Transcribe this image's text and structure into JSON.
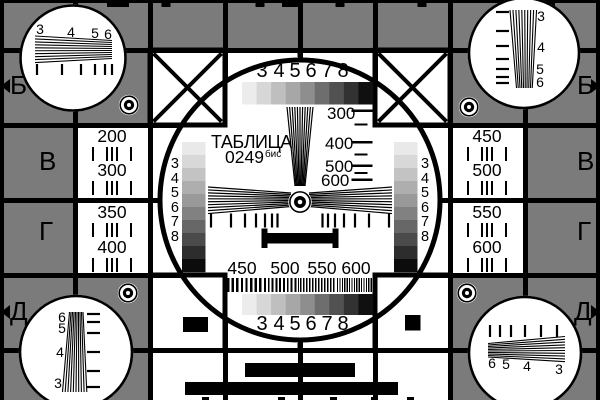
{
  "card": {
    "title": "ТАБЛИЦА",
    "code": "0249",
    "code_suffix": "бис",
    "row_markers": {
      "left": [
        "Б",
        "В",
        "Г",
        "Д"
      ],
      "right": [
        "Б",
        "В",
        "Г",
        "Д"
      ]
    },
    "center": {
      "top_grayscale_labels": [
        "3",
        "4",
        "5",
        "6",
        "7",
        "8"
      ],
      "bottom_grayscale_labels": [
        "3",
        "4",
        "5",
        "6",
        "7",
        "8"
      ],
      "left_step_labels": [
        "3",
        "4",
        "5",
        "6",
        "7",
        "8"
      ],
      "right_step_labels": [
        "3",
        "4",
        "5",
        "6",
        "7",
        "8"
      ],
      "vertical_wedge_labels": [
        "300",
        "400",
        "500",
        "600"
      ],
      "frequency_labels": [
        "450",
        "500",
        "550",
        "600"
      ]
    },
    "side_panels": {
      "left_top": [
        "200",
        "300"
      ],
      "left_bottom": [
        "350",
        "400"
      ],
      "right_top": [
        "450",
        "500"
      ],
      "right_bottom": [
        "550",
        "600"
      ]
    },
    "corner_wedge_labels": {
      "top_left": [
        "3",
        "4",
        "5",
        "6"
      ],
      "top_right": [
        "3",
        "4",
        "5",
        "6"
      ],
      "bottom_left": [
        "6",
        "5",
        "4",
        "3"
      ],
      "bottom_right": [
        "6",
        "5",
        "4",
        "3"
      ]
    }
  },
  "colors": {
    "background_gray": "#7b7b7b",
    "line_black": "#000000",
    "field_white": "#ffffff",
    "grayscale_steps": [
      "#ececec",
      "#d7d7d7",
      "#bfbfbf",
      "#a7a7a7",
      "#8e8e8e",
      "#6e6e6e",
      "#515151",
      "#323232",
      "#101010"
    ],
    "staircase_steps": [
      "#e9e9e9",
      "#d8d8d8",
      "#c3c3c3",
      "#aeaeae",
      "#999999",
      "#818181",
      "#676767",
      "#4b4b4b",
      "#2d2d2d",
      "#0c0c0c"
    ]
  }
}
